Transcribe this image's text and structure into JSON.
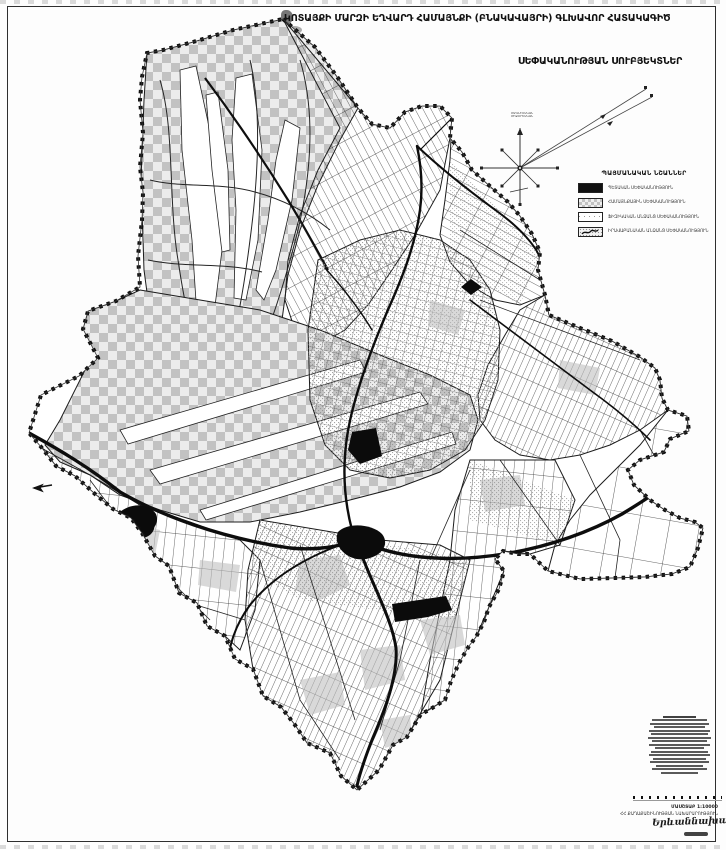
{
  "page": {
    "title": "ԿՈՏԱՅՔԻ ՄԱՐԶԻ ԵՂՎԱՐԴ ՀԱՄԱՅՆՔԻ (ԲՆԱԿԱՎԱՅՐԻ) ԳԼԽԱՎՈՐ ՀԱՏԱԿԱԳԻԾ",
    "subtitle": "ՍԵՓԱԿԱՆՈՒԹՅԱՆ ՍՈՒԲՅԵԿՏՆԵՐ"
  },
  "compass": {
    "label_line1": "ՄԱԳՆԻՍԱԿԱՆ",
    "label_line2": "ՄԻՋՕՐԵԱԿԱՆ"
  },
  "legend": {
    "title": "ՊԱՅՄԱՆԱԿԱՆ ՆՇԱՆՆԵՐ",
    "items": [
      {
        "label": "ՊԵՏԱԿԱՆ ՍԵՓԱԿԱՆՈՒԹՅՈՒՆ",
        "swatch": "solid-black"
      },
      {
        "label": "ՀԱՄԱՅՆՔԱՅԻՆ ՍԵՓԱԿԱՆՈՒԹՅՈՒՆ",
        "swatch": "checker-gray"
      },
      {
        "label": "ՖԻԶԻԿԱԿԱՆ ԱՆՁԱՆՑ ՍԵՓԱԿԱՆՈՒԹՅՈՒՆ",
        "swatch": "white-dashed"
      },
      {
        "label": "ԻՐԱՎԱԲԱՆԱԿԱՆ ԱՆՁԱՆՑ ՍԵՓԱԿԱՆՈՒԹՅՈՒՆ",
        "swatch": "stipple-scribble"
      }
    ]
  },
  "footer": {
    "line1": "ՄԱՍՇՏԱԲ 1:10000",
    "line2": "ՀՀ ՔԱՂԱՔԱՇԻՆՈՒԹՅԱՆ ՆԱԽԱՐԱՐՈՒԹՅՈՒՆ",
    "signature": "Երևաննախագիծ"
  },
  "colors": {
    "ink": "#111111",
    "checker_gray": "#c2c2c2",
    "stipple_gray": "#8d8d8d",
    "paper": "#fdfdfd"
  }
}
